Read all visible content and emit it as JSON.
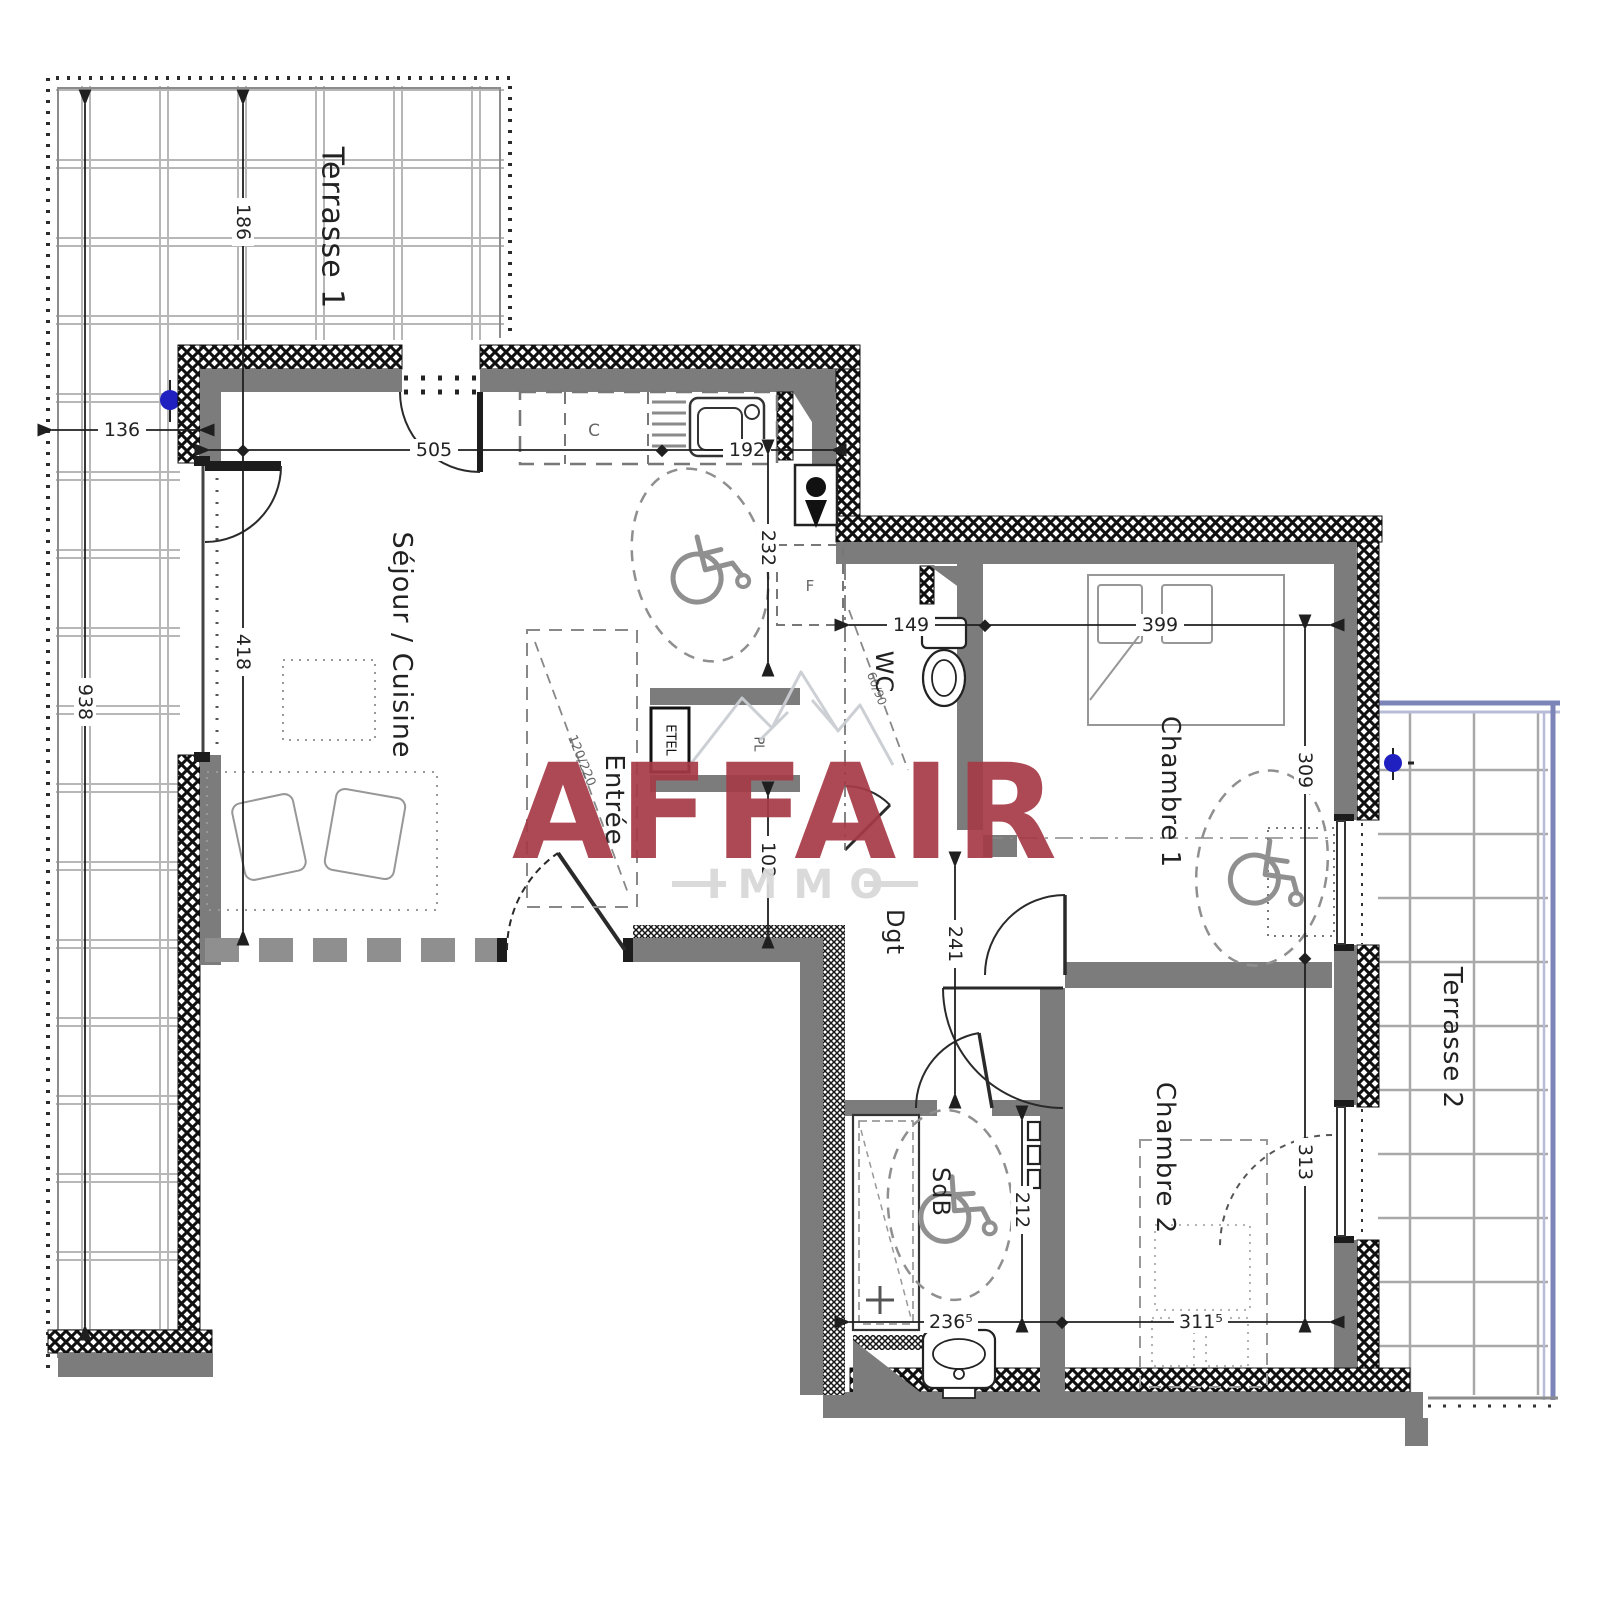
{
  "plan": {
    "rooms": {
      "terrasse1": "Terrasse 1",
      "sejour_cuisine": "Séjour / Cuisine",
      "entree": "Entrée",
      "wc": "WC",
      "chambre1": "Chambre 1",
      "chambre2": "Chambre 2",
      "sdb": "SdB",
      "dgt": "Dgt",
      "terrasse2": "Terrasse 2"
    },
    "annotations": {
      "etel": "ETEL",
      "pl": "PL",
      "hob": "C",
      "fridge": "F",
      "entry_door_size": "120/220",
      "wc_clearance": "60/90"
    },
    "dims": {
      "t1_width": "186",
      "t1_offset": "136",
      "sejour_w": "505",
      "kitchen_w": "192",
      "t1_h": "938",
      "sejour_h": "418",
      "kitchen_h": "232",
      "entree_h": "102",
      "wc_w": "149",
      "ch1_w": "399",
      "ch1_h": "309",
      "dgt_h": "241",
      "sdb_h": "212",
      "sdb_w": "236⁵",
      "ch2_w": "311⁵",
      "ch2_h": "313"
    },
    "watermark": {
      "brand": "AFFAIR",
      "tagline": "IMMO"
    },
    "colors": {
      "wall": "#7c7c7c",
      "hatch_ink": "#101010",
      "tile_line": "#b7b7b7",
      "railing_purple": "#7d84b8",
      "brand_red": "#a53a46",
      "brand_grey": "#d9d9d9",
      "dim_ink": "#232323",
      "drain_blue": "#2020c0"
    }
  }
}
